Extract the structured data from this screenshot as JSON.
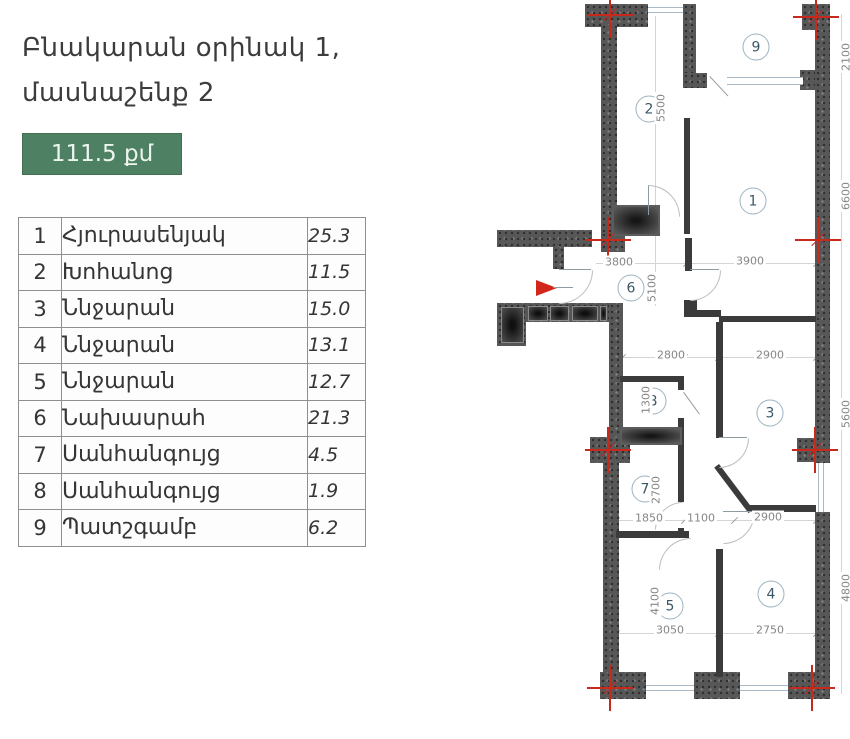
{
  "header": {
    "title_line1": "Բնակարան օրինակ 1,",
    "title_line2": "մասնաշենք 2",
    "area_badge": "111.5 քմ"
  },
  "rooms_table": {
    "rows": [
      {
        "num": "1",
        "name": "Հյուրասենյակ",
        "area": "25.3"
      },
      {
        "num": "2",
        "name": "Խոհանոց",
        "area": "11.5"
      },
      {
        "num": "3",
        "name": "Ննջարան",
        "area": "15.0"
      },
      {
        "num": "4",
        "name": "Ննջարան",
        "area": "13.1"
      },
      {
        "num": "5",
        "name": "Ննջարան",
        "area": "12.7"
      },
      {
        "num": "6",
        "name": "Նախասրահ",
        "area": "21.3"
      },
      {
        "num": "7",
        "name": "Սանհանգույց",
        "area": "4.5"
      },
      {
        "num": "8",
        "name": "Սանհանգույց",
        "area": "1.9"
      },
      {
        "num": "9",
        "name": "Պատշգամբ",
        "area": "6.2"
      }
    ]
  },
  "floor_plan": {
    "room_labels": [
      {
        "t": "9",
        "x": 756,
        "y": 47
      },
      {
        "t": "2",
        "x": 649,
        "y": 109
      },
      {
        "t": "1",
        "x": 753,
        "y": 201
      },
      {
        "t": "6",
        "x": 631,
        "y": 288
      },
      {
        "t": "3",
        "x": 770,
        "y": 413
      },
      {
        "t": "8",
        "x": 653,
        "y": 401
      },
      {
        "t": "7",
        "x": 645,
        "y": 489
      },
      {
        "t": "5",
        "x": 670,
        "y": 606
      },
      {
        "t": "4",
        "x": 771,
        "y": 594
      }
    ],
    "dimensions": [
      {
        "t": "5500",
        "x": 661,
        "y": 108,
        "rot": true
      },
      {
        "t": "3800",
        "x": 619,
        "y": 262
      },
      {
        "t": "3900",
        "x": 750,
        "y": 261
      },
      {
        "t": "5100",
        "x": 652,
        "y": 288,
        "rot": true
      },
      {
        "t": "2800",
        "x": 671,
        "y": 355
      },
      {
        "t": "2900",
        "x": 770,
        "y": 355
      },
      {
        "t": "1300",
        "x": 646,
        "y": 400,
        "rot": true
      },
      {
        "t": "2700",
        "x": 656,
        "y": 490,
        "rot": true
      },
      {
        "t": "1850",
        "x": 649,
        "y": 518
      },
      {
        "t": "1100",
        "x": 701,
        "y": 518
      },
      {
        "t": "2900",
        "x": 768,
        "y": 517
      },
      {
        "t": "4100",
        "x": 655,
        "y": 601,
        "rot": true
      },
      {
        "t": "3050",
        "x": 670,
        "y": 630
      },
      {
        "t": "2750",
        "x": 770,
        "y": 630
      },
      {
        "t": "2100",
        "x": 846,
        "y": 57,
        "rot": true
      },
      {
        "t": "6600",
        "x": 846,
        "y": 196,
        "rot": true
      },
      {
        "t": "5600",
        "x": 846,
        "y": 414,
        "rot": true
      },
      {
        "t": "4800",
        "x": 846,
        "y": 588,
        "rot": true
      }
    ]
  },
  "colors": {
    "badge_green": "#4e8163",
    "marker_red": "#c7291d",
    "wall_dark": "#575757"
  }
}
